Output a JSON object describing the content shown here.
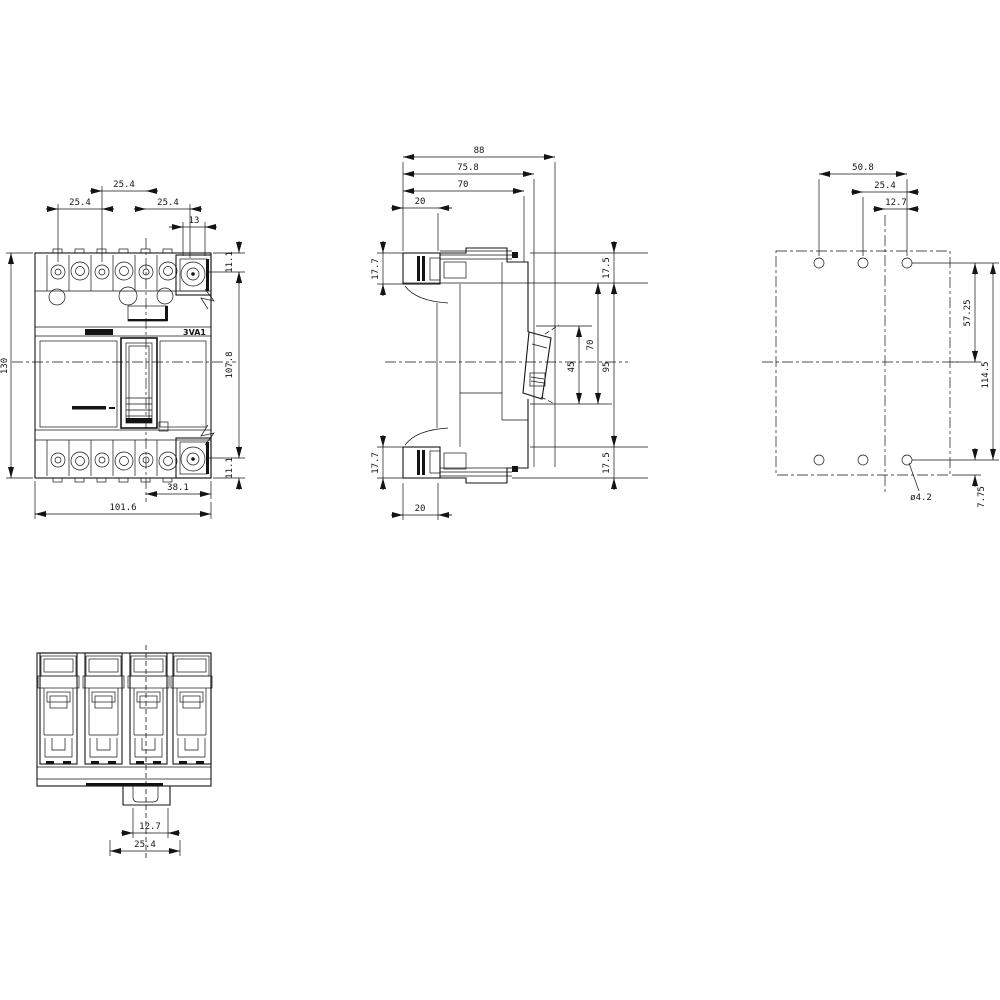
{
  "title": "3VA1 molded case circuit breaker dimension drawing",
  "product_label": "3VA1",
  "front": {
    "pitch_left": "25.4",
    "pitch_center": "25.4",
    "pitch_right": "25.4",
    "terminal_width": "13",
    "offset_top": "11.1",
    "offset_bottom": "11.1",
    "height": "130",
    "hole_pitch_vertical": "107.8",
    "center_to_edge": "38.1",
    "width": "101.6"
  },
  "side": {
    "depth_total": "88",
    "depth_handle": "75.8",
    "depth_body": "70",
    "terminal_depth_top": "20",
    "terminal_height_top": "17.7",
    "terminal_height_bottom": "17.7",
    "step_top": "17.5",
    "handle_height": "70",
    "handle_span": "45",
    "front_height": "95",
    "step_bottom": "17.5",
    "terminal_depth_bottom": "20"
  },
  "rear": {
    "hole_span": "50.8",
    "hole_pitch": "25.4",
    "hole_offset": "12.7",
    "hole_to_center": "57.25",
    "hole_span_vertical": "114.5",
    "hole_edge": "7.75",
    "hole_diameter": "ø4.2"
  },
  "bottom": {
    "slot_width": "12.7",
    "slot_pitch": "25.4"
  }
}
